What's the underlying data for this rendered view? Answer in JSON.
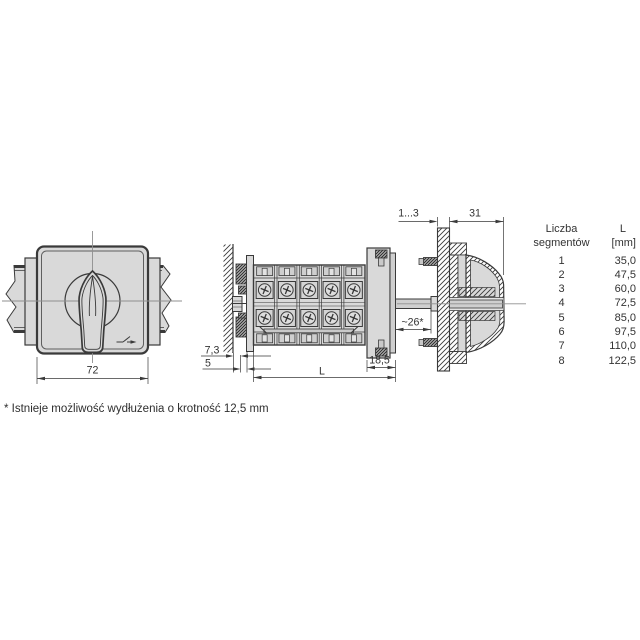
{
  "front_view": {
    "width_dim": "72"
  },
  "side_view": {
    "dim_offset": "7,3",
    "dim_base_depth": "5",
    "dim_length": "L",
    "dim_front_depth": "18,5",
    "dim_shaft_length": "~26*"
  },
  "panel_view": {
    "dim_panel_thickness": "1...3",
    "dim_handle_depth": "31"
  },
  "table": {
    "header": {
      "col1_line1": "Liczba",
      "col1_line2": "segmentów",
      "col2_line1": "L",
      "col2_line2": "[mm]"
    },
    "rows": [
      {
        "segments": "1",
        "l_mm": "35,0"
      },
      {
        "segments": "2",
        "l_mm": "47,5"
      },
      {
        "segments": "3",
        "l_mm": "60,0"
      },
      {
        "segments": "4",
        "l_mm": "72,5"
      },
      {
        "segments": "5",
        "l_mm": "85,0"
      },
      {
        "segments": "6",
        "l_mm": "97,5"
      },
      {
        "segments": "7",
        "l_mm": "110,0"
      },
      {
        "segments": "8",
        "l_mm": "122,5"
      }
    ]
  },
  "footnote": "* Istnieje możliwość wydłużenia o krotność 12,5 mm",
  "colors": {
    "background": "#ffffff",
    "line": "#3a3a3a",
    "fill_light": "#d9d9d9",
    "fill_mid": "#cfcfcf",
    "centerline": "#8f8f8f"
  }
}
